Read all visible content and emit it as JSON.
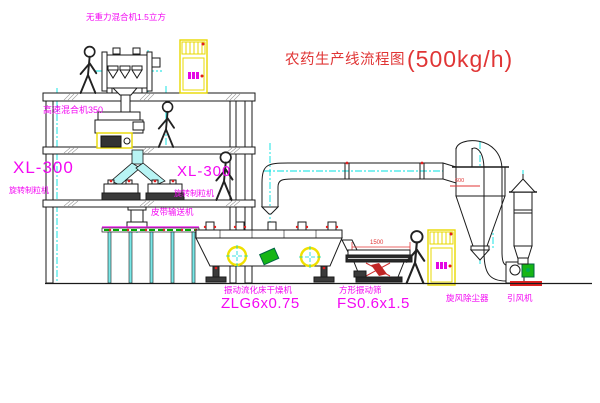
{
  "title": {
    "name_cn": "农药生产线流程图",
    "capacity": "(500kg/h)"
  },
  "labels": {
    "gravity_mixer": "无重力混合机1.5立方",
    "high_speed_mixer": "高速混合机350",
    "granulator_left_model": "XL-300",
    "granulator_left_name": "旋转制粒机",
    "granulator_right_model": "XL-300",
    "granulator_right_name": "旋转制粒机",
    "belt_conveyor": "皮带输送机",
    "fluid_bed_dryer_name": "振动流化床干燥机",
    "fluid_bed_dryer_model": "ZLG6x0.75",
    "vibrating_sieve_name": "方形振动筛",
    "vibrating_sieve_model": "FS0.6x1.5",
    "cyclone": "旋风除尘器",
    "induced_draft_fan": "引风机"
  },
  "dimensions": {
    "sieve_length": "1500",
    "cyclone_marking": "600"
  },
  "colors": {
    "label_magenta": "#ff00ff",
    "title_red": "#e03535",
    "centerline_cyan": "#00e8e8",
    "cabinet_yellow": "#f2e400",
    "accent_green": "#00aa00",
    "line_black": "#1a1a1a"
  }
}
